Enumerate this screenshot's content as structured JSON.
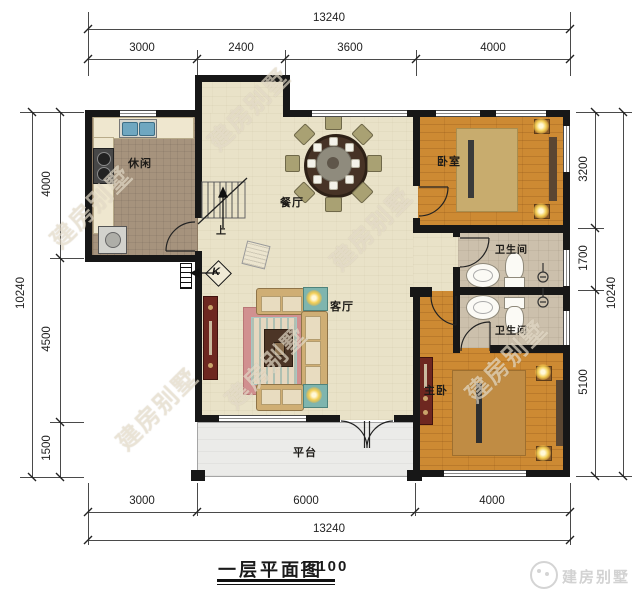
{
  "title": {
    "text": "一层平面图",
    "scale": "1:100"
  },
  "brand": {
    "name": "建房别墅"
  },
  "watermark": {
    "text": "建房别墅"
  },
  "dimensions": {
    "top": {
      "total": "13240",
      "segments": [
        "3000",
        "2400",
        "3600",
        "4000"
      ]
    },
    "bottom": {
      "total": "13240",
      "segments": [
        "3000",
        "6000",
        "4000"
      ]
    },
    "left": {
      "total": "10240",
      "segments": [
        "4000",
        "4500",
        "1500"
      ]
    },
    "right": {
      "total": "10240",
      "segments": [
        "3200",
        "1700",
        "5100"
      ]
    }
  },
  "rooms": {
    "leisure": "休闲",
    "dining": "餐厅",
    "living": "客厅",
    "bedroom": "卧室",
    "bath1": "卫生间",
    "bath2": "卫生间",
    "master": "主卧",
    "terrace": "平台"
  },
  "stairs": {
    "up_label": "上"
  },
  "annotations": {
    "electric_box": "K"
  },
  "colors": {
    "wall": "#171717",
    "floor_main": "#e9e2c8",
    "floor_wood": "#cd8a33",
    "floor_bath": "#ccc0ac",
    "floor_leisure": "#a6937d",
    "cabinet_red": "#6e2720",
    "rug_pink": "#d19090",
    "lamp_yellow": "#f3cf56"
  }
}
